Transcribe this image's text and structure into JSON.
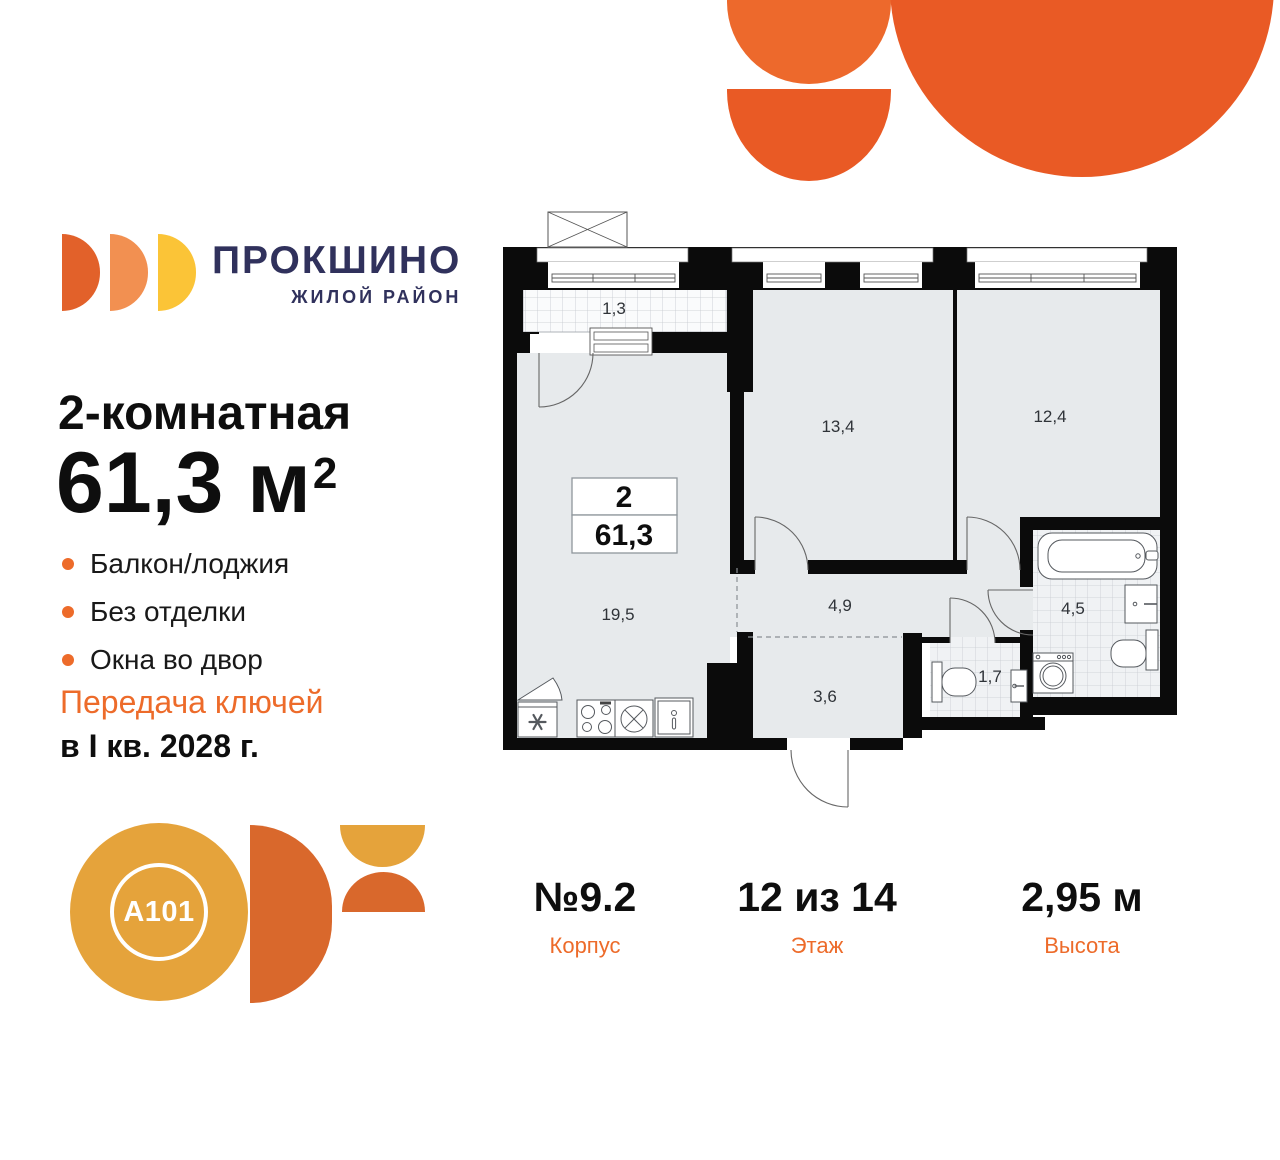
{
  "brand": {
    "name": "ПРОКШИНО",
    "tagline": "ЖИЛОЙ РАЙОН"
  },
  "listing": {
    "rooms_title": "2-комнатная",
    "area": "61,3",
    "area_unit": "м",
    "area_exp": "2",
    "features": [
      "Балкон/лоджия",
      "Без отделки",
      "Окна во двор"
    ],
    "handover_line1": "Передача ключей",
    "handover_line2": "в I кв. 2028 г."
  },
  "plan": {
    "info_box": {
      "rooms": "2",
      "area": "61,3"
    },
    "labels": {
      "balcony": "1,3",
      "bedroom1": "13,4",
      "bedroom2": "12,4",
      "living": "19,5",
      "hallway": "4,9",
      "entry": "3,6",
      "wc": "1,7",
      "bathroom": "4,5"
    }
  },
  "stats": [
    {
      "value": "№9.2",
      "label": "Корпус"
    },
    {
      "value": "12 из 14",
      "label": "Этаж"
    },
    {
      "value": "2,95 м",
      "label": "Высота"
    }
  ],
  "developer": {
    "name": "A101"
  },
  "colors": {
    "accent_orange": "#ED6B2A",
    "deco_orange": "#E95A25",
    "logo_navy": "#30315C",
    "gold": "#E5A33B",
    "dark_orange": "#D9682C",
    "room_fill": "#E7EAEC",
    "wall": "#0B0B0B"
  }
}
